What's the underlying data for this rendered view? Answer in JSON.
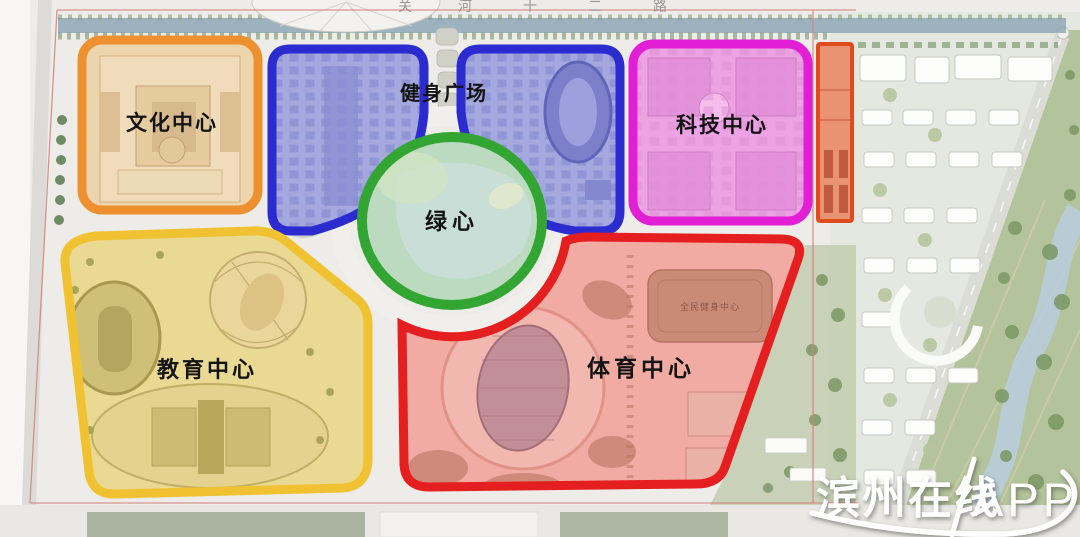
{
  "road_labels": {
    "top_road": [
      "关",
      "河",
      "十",
      "二",
      "路"
    ]
  },
  "zones": {
    "culture": {
      "label": "文化中心",
      "outline": "#ef9030"
    },
    "fitness": {
      "label": "健身广场",
      "outline": "#2b2bd0"
    },
    "tech": {
      "label": "科技中心",
      "outline": "#e31fd6"
    },
    "green_heart": {
      "label": "绿心",
      "outline": "#32a532"
    },
    "education": {
      "label": "教育中心",
      "outline": "#f0c232"
    },
    "sports": {
      "label": "体育中心",
      "outline": "#e51f1f"
    },
    "east_strip": {
      "outline": "#e04b1e"
    }
  },
  "buildings": {
    "fitness_center": "全民健身中心"
  },
  "watermark": {
    "brand": "滨州在线",
    "suffix": "APP",
    "color": "#ffffff"
  }
}
